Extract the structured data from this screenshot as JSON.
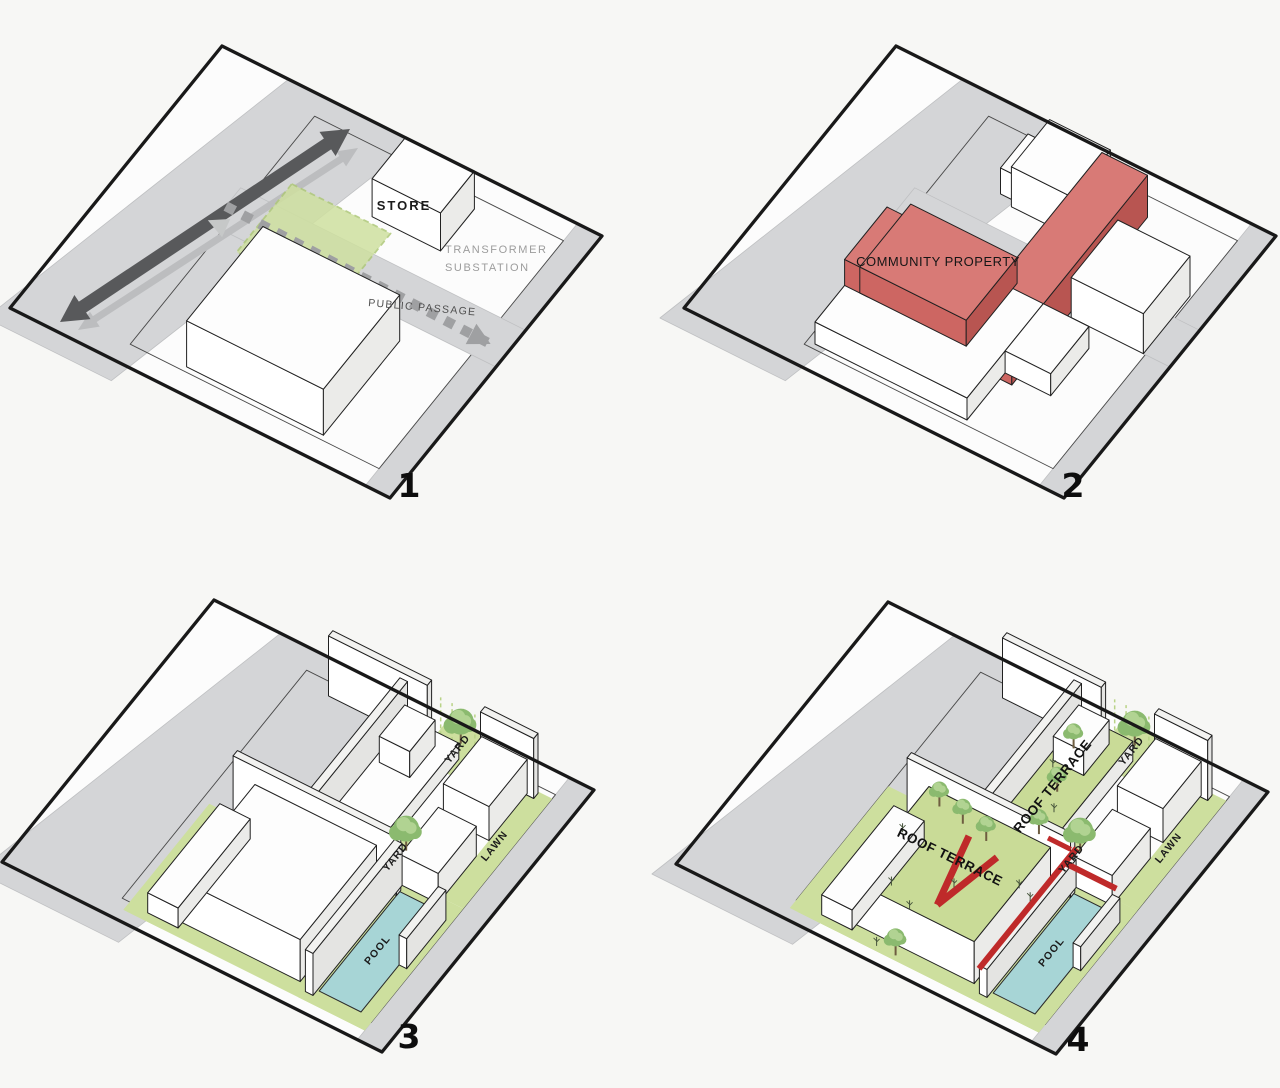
{
  "figure": {
    "type": "architectural-axonometric-site-diagrams",
    "panel_count": 4
  },
  "panels": [
    {
      "id": 1,
      "number": "1",
      "labels": {
        "store": "STORE",
        "transformer_line1": "TRANSFORMER",
        "transformer_line2": "SUBSTATION",
        "public_passage": "PUBLIC PASSAGE"
      }
    },
    {
      "id": 2,
      "number": "2",
      "labels": {
        "community_property": "COMMUNITY PROPERTY"
      }
    },
    {
      "id": 3,
      "number": "3",
      "labels": {
        "yard_north": "YARD",
        "yard_middle": "YARD",
        "lawn": "LAWN",
        "pool": "POOL"
      }
    },
    {
      "id": 4,
      "number": "4",
      "labels": {
        "roof_terrace_west": "ROOF TERRACE",
        "roof_terrace_north": "ROOF TERRACE",
        "yard_north": "YARD",
        "yard_middle": "YARD",
        "lawn": "LAWN",
        "pool": "POOL"
      }
    }
  ],
  "palette": {
    "background": "#f7f7f5",
    "site_fill": "#fcfcfc",
    "road": "#d4d5d7",
    "road_edge": "#bfc0c2",
    "outline": "#191919",
    "box_outline": "#212121",
    "parcel_line": "#4a4a4a",
    "arrow_dark": "#58595b",
    "arrow_light": "#bcbdbf",
    "arrow_dashed": "#9fa0a2",
    "arrow_dashed_light": "#c6c8c8",
    "green_area": "#cfe0a0",
    "green_border": "#aec878",
    "lawn": "#cddf9e",
    "terrace": "#c9db97",
    "pool": "#a7d5d6",
    "pool_edge": "#2b2b2b",
    "red_top": "#d87a76",
    "red_left": "#cd6662",
    "red_right": "#b85551",
    "stair_red": "#bf2a2a",
    "tree": "#8bba6f",
    "tree_light": "#b1d392",
    "trunk": "#6e5d40",
    "hedge": "#b9d387",
    "white_top": "#fdfdfd",
    "white_left": "#ffffff",
    "white_right": "#ebebe9",
    "wall_top": "#f2f2f0"
  }
}
